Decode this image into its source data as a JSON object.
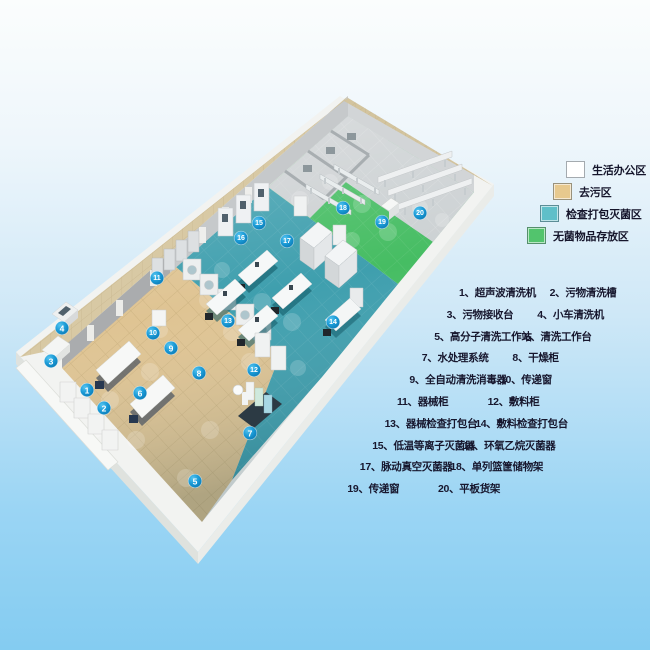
{
  "legend": {
    "items": [
      {
        "label": "生活办公区",
        "color": "#ffffff"
      },
      {
        "label": "去污区",
        "color": "#e7c98e"
      },
      {
        "label": "检查打包灭菌区",
        "color": "#5fbfc9"
      },
      {
        "label": "无菌物品存放区",
        "color": "#52c46d"
      }
    ]
  },
  "equipment": {
    "rows": [
      {
        "left": "1、超声波清洗机",
        "right": "2、污物清洗槽"
      },
      {
        "left": "3、污物接收台",
        "right": "4、小车清洗机"
      },
      {
        "left": "5、高分子清洗工作站",
        "right": "6、清洗工作台"
      },
      {
        "left": "7、水处理系统",
        "right": "8、干燥柜"
      },
      {
        "left": "9、全自动清洗消毒器",
        "right": "10、传递窗"
      },
      {
        "left": "11、器械柜",
        "right": "12、敷料柜"
      },
      {
        "left": "13、器械检查打包台",
        "right": "14、敷料检查打包台"
      },
      {
        "left": "15、低温等离子灭菌器",
        "right": "16、环氧乙烷灭菌器"
      },
      {
        "left": "17、脉动真空灭菌器",
        "right": "18、单列篮筐储物架"
      },
      {
        "left": "19、传递窗",
        "right": "20、平板货架"
      }
    ]
  },
  "plan": {
    "marker_color": "#1295d2",
    "zone_colors": {
      "decontamination": "#dfc493",
      "packing": "#3f9fae",
      "sterile": "#46bd63",
      "storage_gray": "#ccd1d3",
      "office": "#cdd1d3"
    },
    "markers": [
      {
        "n": "1",
        "x": 87,
        "y": 390
      },
      {
        "n": "2",
        "x": 104,
        "y": 408
      },
      {
        "n": "3",
        "x": 51,
        "y": 361
      },
      {
        "n": "4",
        "x": 62,
        "y": 328
      },
      {
        "n": "5",
        "x": 195,
        "y": 481
      },
      {
        "n": "6",
        "x": 140,
        "y": 393
      },
      {
        "n": "7",
        "x": 250,
        "y": 433
      },
      {
        "n": "8",
        "x": 199,
        "y": 373
      },
      {
        "n": "9",
        "x": 171,
        "y": 348
      },
      {
        "n": "10",
        "x": 153,
        "y": 333
      },
      {
        "n": "11",
        "x": 157,
        "y": 278
      },
      {
        "n": "12",
        "x": 254,
        "y": 370
      },
      {
        "n": "13",
        "x": 228,
        "y": 321
      },
      {
        "n": "14",
        "x": 333,
        "y": 322
      },
      {
        "n": "15",
        "x": 259,
        "y": 223
      },
      {
        "n": "16",
        "x": 241,
        "y": 238
      },
      {
        "n": "17",
        "x": 287,
        "y": 241
      },
      {
        "n": "18",
        "x": 343,
        "y": 208
      },
      {
        "n": "19",
        "x": 382,
        "y": 222
      },
      {
        "n": "20",
        "x": 420,
        "y": 213
      }
    ]
  }
}
